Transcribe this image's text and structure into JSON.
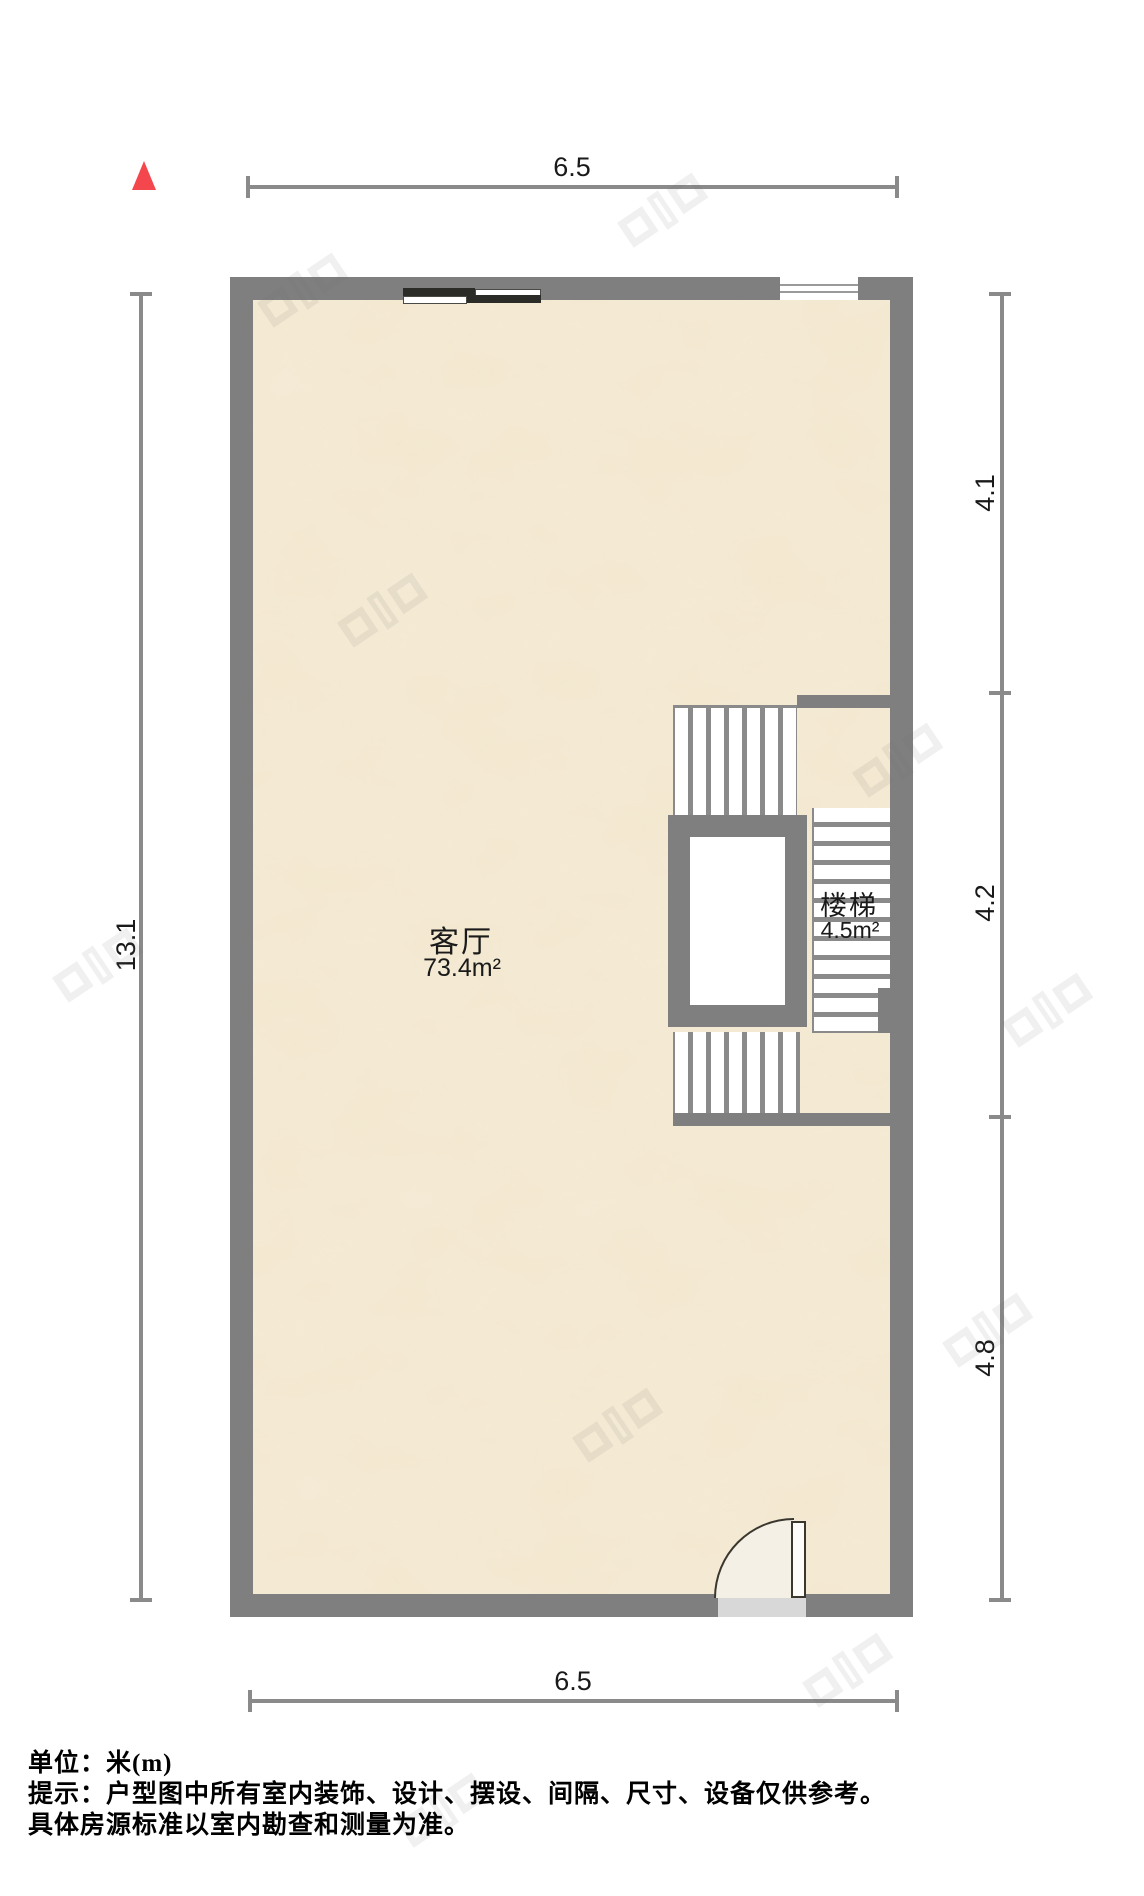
{
  "floorplan": {
    "dims": {
      "top": "6.5",
      "bottom": "6.5",
      "left": "13.1",
      "right_upper": "4.1",
      "right_middle": "4.2",
      "right_lower": "4.8"
    },
    "rooms": {
      "living": {
        "name": "客厅",
        "area": "73.4m²"
      },
      "stairs": {
        "name": "楼梯",
        "area": "4.5m²"
      }
    },
    "colors": {
      "wall": "#7f7f7f",
      "dim_line": "#8a8a8a",
      "north": "#f4474d",
      "floor_base": "#f5ebd6",
      "door_fill": "#f4f0e5",
      "tv_dark": "#2b2b27",
      "threshold": "#d8d8d8"
    }
  },
  "footer": {
    "unit_line": "单位：米(m)",
    "tip_line": "提示：户型图中所有室内装饰、设计、摆设、间隔、尺寸、设备仅供参考。",
    "tip_line2": "具体房源标准以室内勘查和测量为准。"
  }
}
